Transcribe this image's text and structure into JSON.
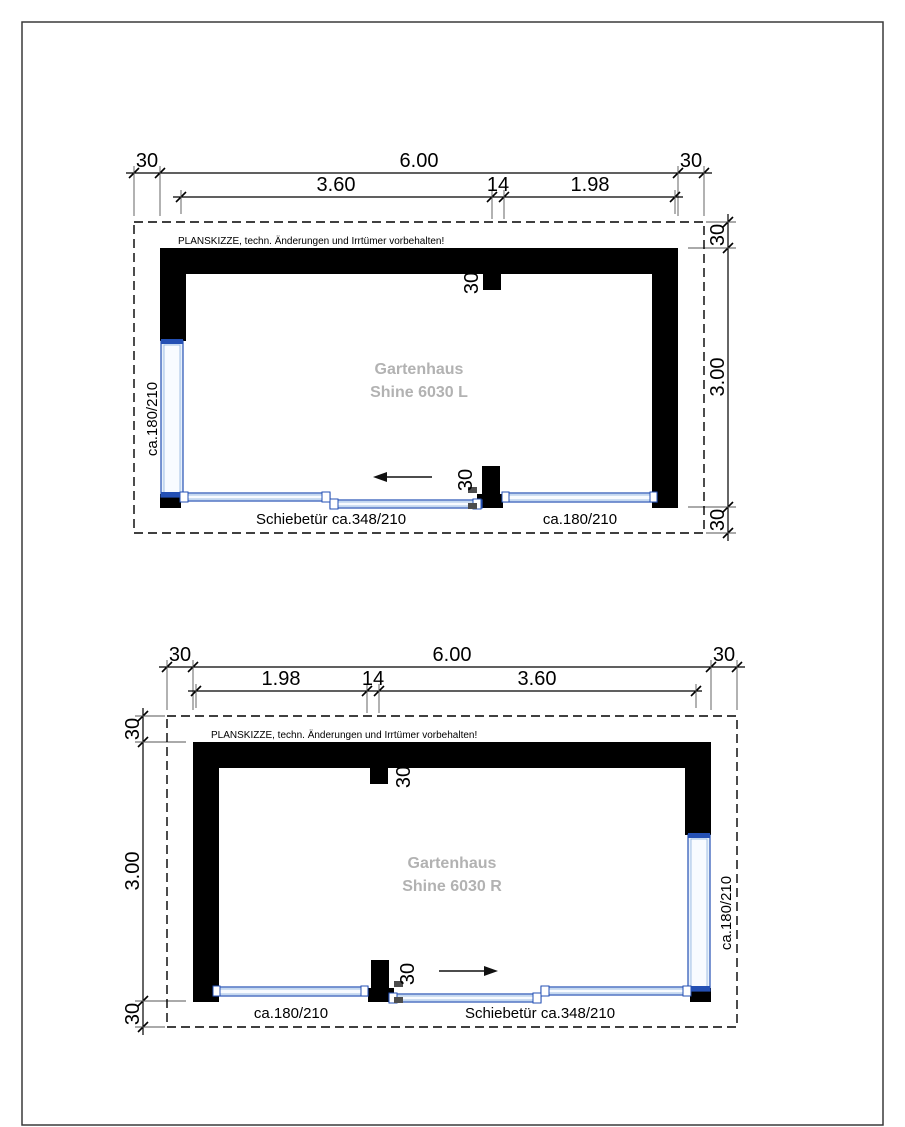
{
  "page": {
    "background": "#ffffff",
    "frame_color": "#3a3a3a"
  },
  "colors": {
    "wall": "#000000",
    "glazing_stroke": "#2450b4",
    "glazing_fill": "#e8f1fb",
    "title_gray": "#b2b2b2",
    "dimension_text": "#000000"
  },
  "disclaimer": "PLANSKIZZE, techn. Änderungen und Irrtümer vorbehalten!",
  "plans": [
    {
      "name": "Shine 6030 L",
      "title_line1": "Gartenhaus",
      "title_line2": "Shine 6030 L",
      "dim_top": {
        "left_overhang": "30",
        "total": "6.00",
        "right_overhang": "30"
      },
      "dim_sub": {
        "left": "3.60",
        "mid": "14",
        "right": "1.98"
      },
      "dim_side": {
        "top": "30",
        "height": "3.00",
        "bottom": "30"
      },
      "stub_top": "30",
      "stub_bottom": "30",
      "door_label": "Schiebetür ca.348/210",
      "window_bottom_label": "ca.180/210",
      "window_side_label": "ca.180/210",
      "door_slide_direction": "left"
    },
    {
      "name": "Shine 6030 R",
      "title_line1": "Gartenhaus",
      "title_line2": "Shine 6030 R",
      "dim_top": {
        "left_overhang": "30",
        "total": "6.00",
        "right_overhang": "30"
      },
      "dim_sub": {
        "left": "1.98",
        "mid": "14",
        "right": "3.60"
      },
      "dim_side": {
        "top": "30",
        "height": "3.00",
        "bottom": "30"
      },
      "stub_top": "30",
      "stub_bottom": "30",
      "door_label": "Schiebetür ca.348/210",
      "window_bottom_label": "ca.180/210",
      "window_side_label": "ca.180/210",
      "door_slide_direction": "right"
    }
  ]
}
